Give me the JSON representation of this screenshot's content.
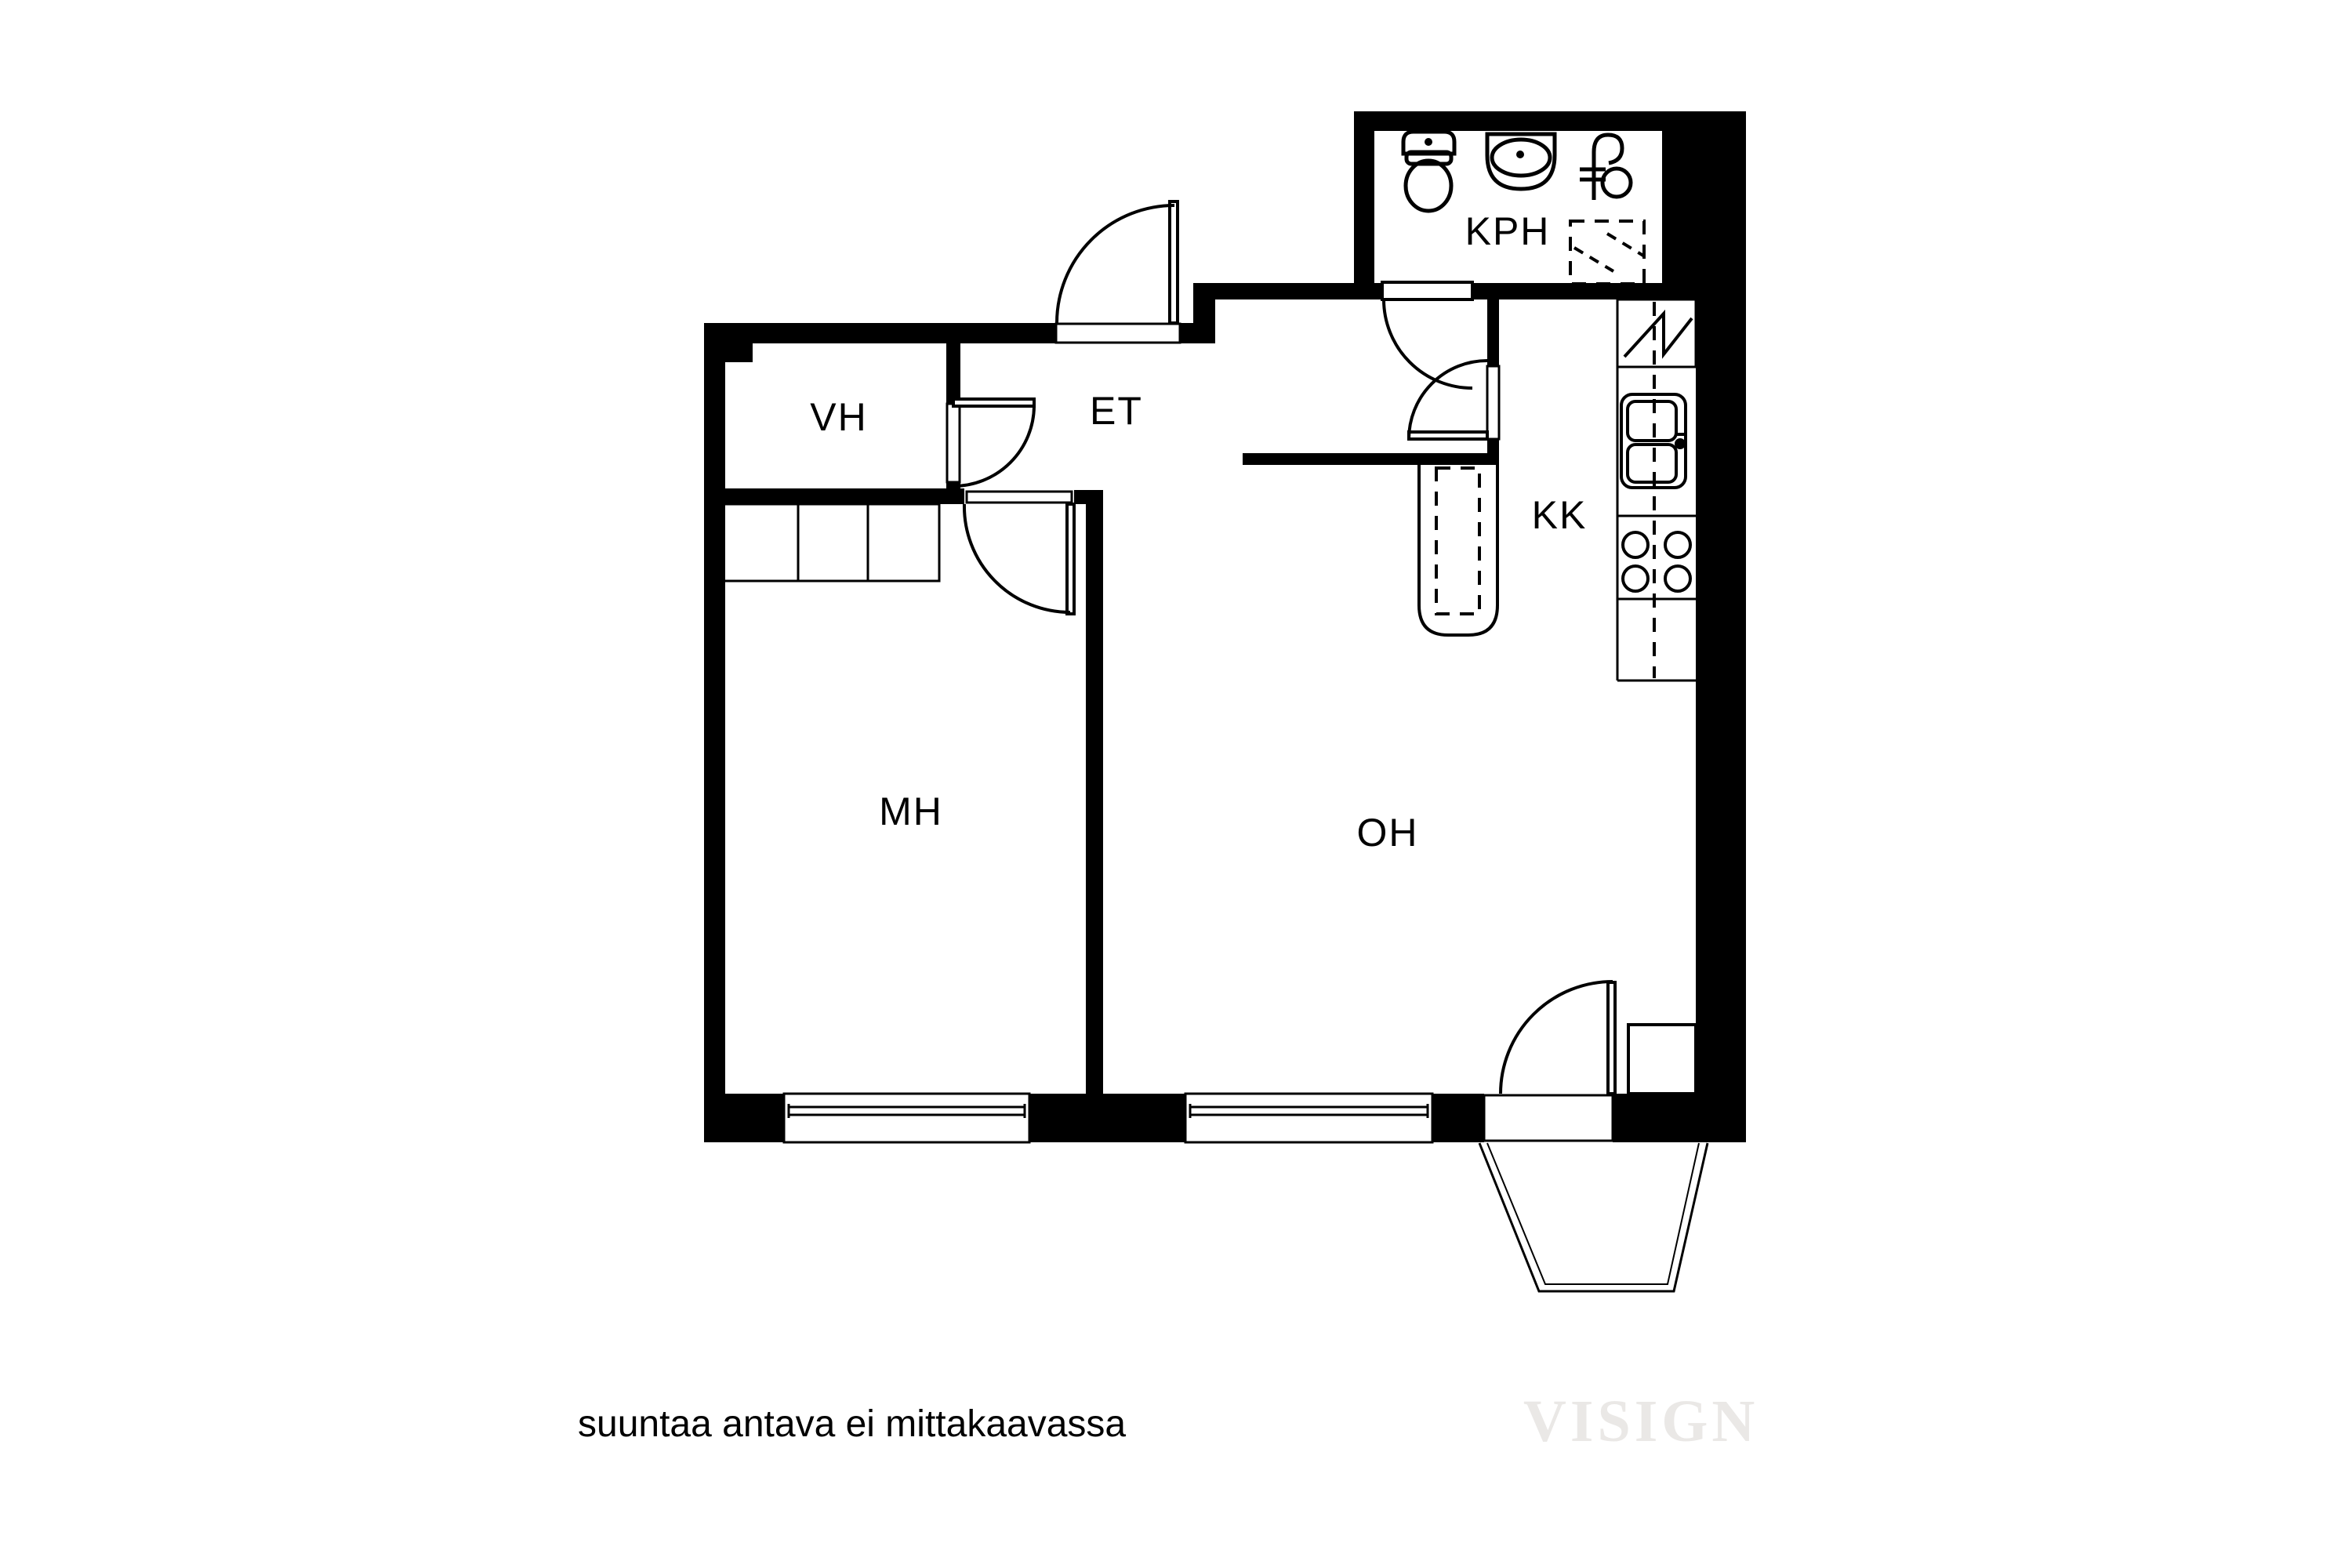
{
  "title": "apartment-floor-plan",
  "rooms": {
    "vh": {
      "label": "VH"
    },
    "et": {
      "label": "ET"
    },
    "kph": {
      "label": "KPH"
    },
    "kk": {
      "label": "KK"
    },
    "mh": {
      "label": "MH"
    },
    "oh": {
      "label": "OH"
    }
  },
  "footer": {
    "disclaimer": "suuntaa antava ei mittakaavassa",
    "watermark": "VISIGN"
  },
  "colors": {
    "wall": "#000000",
    "background": "#ffffff",
    "watermark": "#eae8e6"
  }
}
